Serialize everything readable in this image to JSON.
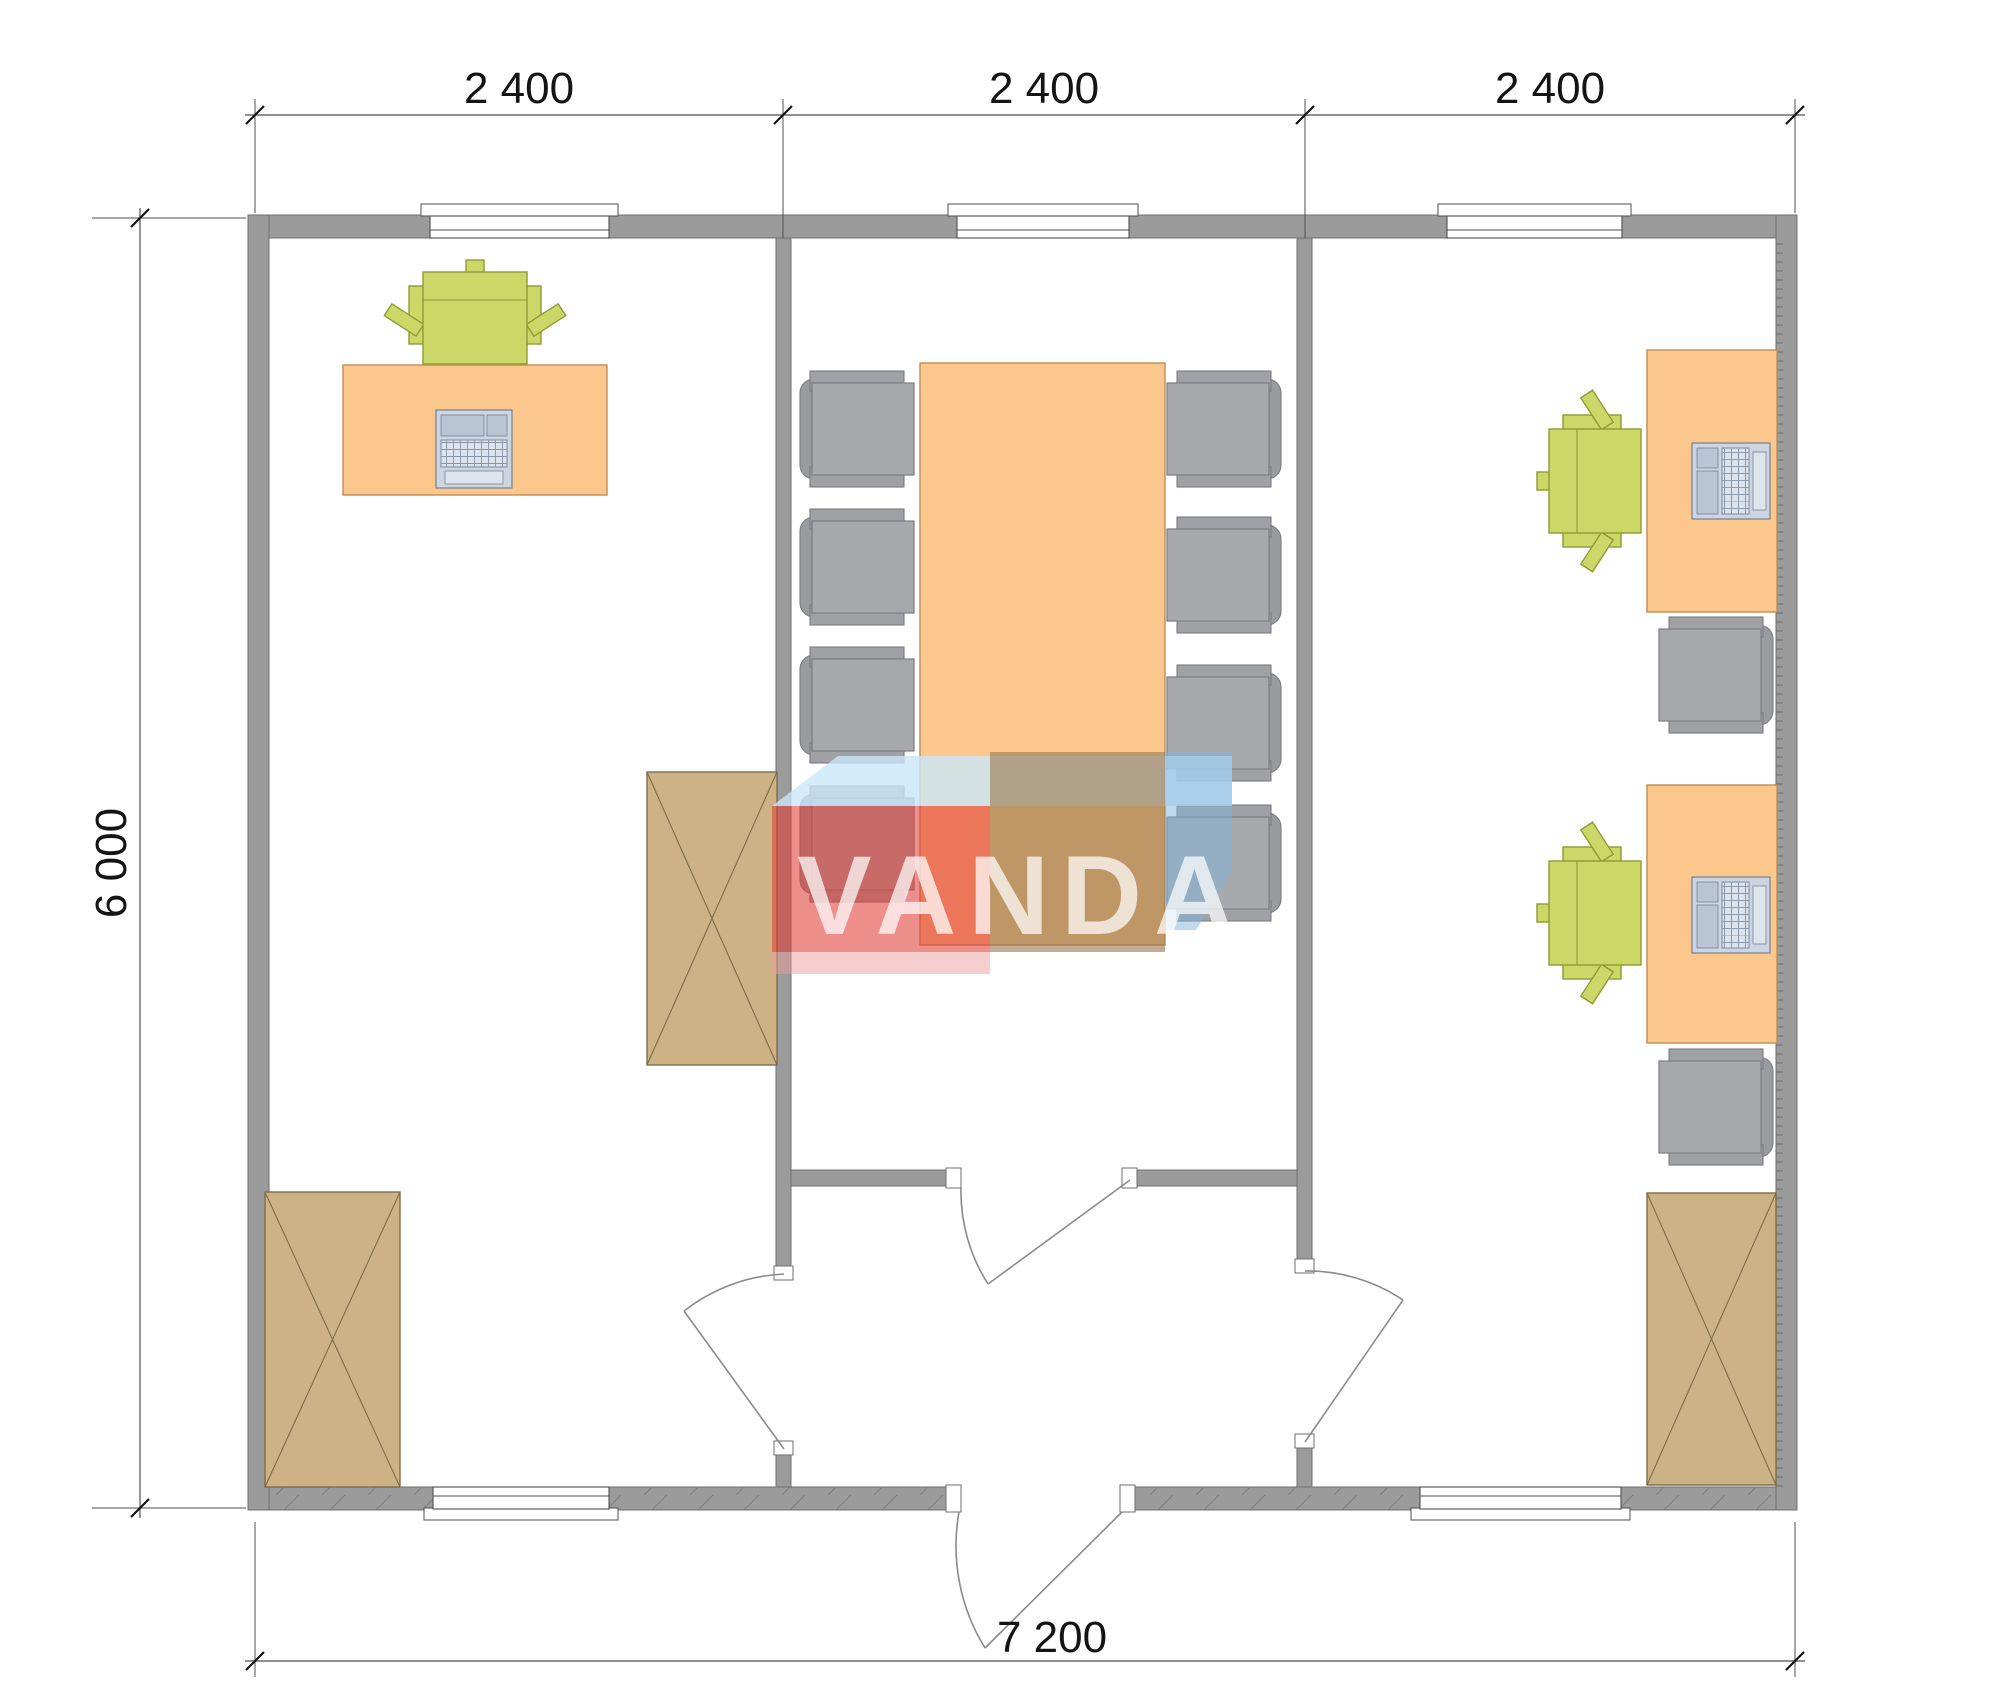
{
  "watermark": {
    "brand": "VANDA"
  },
  "dimensions": {
    "top": [
      "2 400",
      "2 400",
      "2 400"
    ],
    "left": "6 000",
    "bottom": "7 200"
  },
  "furniture_icons": [
    "office-desk",
    "conference-table",
    "office-chair-green",
    "office-chair-gray",
    "laptop",
    "storage-cabinet-crossed",
    "door-swing",
    "window"
  ],
  "palette": {
    "wall": "#9b9b9b",
    "wall_edge": "#6f6f6f",
    "line": "#4f4f4f",
    "dim_text": "#141414",
    "door_line": "#8a8a8a",
    "desk": "#fcc78d",
    "desk_edge": "#bf8d53",
    "chair_green": "#cbd867",
    "chair_green_edge": "#8f9a36",
    "chair_gray": "#a8a9ac",
    "chair_gray_arm": "#a0a1a5",
    "chair_gray_back": "#999b9f",
    "chair_gray_edge": "#7b7c80",
    "cabinet": "#cdb286",
    "cabinet_edge": "#7d6c49",
    "laptop": "#ccd5e1",
    "laptop_pane": "#b9c5d5",
    "laptop_tray": "#dee4ec",
    "laptop_edge": "#69788f",
    "wm_red": "#e03c36",
    "wm_pink": "#ec9d9d",
    "wm_tan": "#9a7950",
    "wm_blue": "#7fb3dc",
    "wm_top": "#c9e7f9",
    "wm_text": "#ffffff"
  }
}
